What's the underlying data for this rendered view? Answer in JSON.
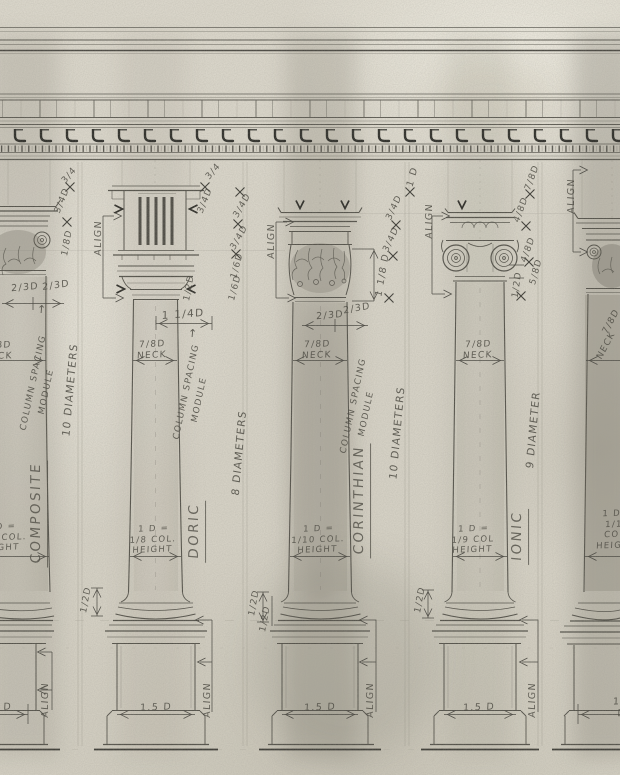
{
  "drawing": {
    "subject": "Classical orders of architecture — comparative column study in pencil",
    "orders": [
      {
        "name": "COMPOSITE",
        "height": "10 DIAMETERS",
        "neck": "7/8D NECK",
        "diameter_rule": "1 D = 1/10 COL. HEIGHT",
        "spacing": "COLUMN SPACING MODULE",
        "pedestal_width": "1.5 D"
      },
      {
        "name": "DORIC",
        "height": "8 DIAMETERS",
        "neck": "7/8D NECK",
        "diameter_rule": "1 D = 1/8 COL. HEIGHT",
        "spacing": "COLUMN SPACING MODULE",
        "pedestal_width": "1.5 D"
      },
      {
        "name": "CORINTHIAN",
        "height": "10 DIAMETERS",
        "neck": "7/8D NECK",
        "diameter_rule": "1 D = 1/10 COL. HEIGHT",
        "spacing": "COLUMN SPACING MODULE",
        "pedestal_width": "1.5 D"
      },
      {
        "name": "IONIC",
        "height": "9 DIAMETER",
        "neck": "7/8D NECK",
        "diameter_rule": "1 D = 1/9 COL HEIGHT",
        "spacing": "COLUMN SPACING MODULE",
        "pedestal_width": "1.5 D"
      }
    ]
  },
  "palette": {
    "paper": "#d7d3c7",
    "pencil": "#55534b",
    "pencil_dark": "#32312c",
    "handwriting": "#4b4941"
  },
  "annotations": [
    {
      "t": "3/4",
      "x": 70,
      "y": 176,
      "r": -50,
      "s": 9
    },
    {
      "t": "3/4D",
      "x": 63,
      "y": 201,
      "r": -68,
      "s": 9
    },
    {
      "t": "1/8D",
      "x": 68,
      "y": 243,
      "r": -80,
      "s": 9
    },
    {
      "t": "ALIGN",
      "x": 99,
      "y": 238,
      "r": -90,
      "s": 9.5,
      "n": "align-label"
    },
    {
      "t": "2/3D",
      "x": 25,
      "y": 288,
      "r": -5,
      "s": 9.5
    },
    {
      "t": "2/3D",
      "x": 56,
      "y": 286,
      "r": -8,
      "s": 9.5
    },
    {
      "t": "↑",
      "x": 42,
      "y": 310,
      "r": 0,
      "s": 11,
      "n": "arrow-up-icon"
    },
    {
      "t": "COLUMN SPACING",
      "x": 34,
      "y": 383,
      "r": -78,
      "s": 8.8,
      "n": "module-label"
    },
    {
      "t": "MODULE",
      "x": 47,
      "y": 392,
      "r": -78,
      "s": 8.8,
      "n": "module-label"
    },
    {
      "t": "10  DIAMETERS",
      "x": 71,
      "y": 390,
      "r": -85,
      "s": 10.5,
      "n": "diameters-label"
    },
    {
      "t": "COMPOSITE",
      "x": 38,
      "y": 513,
      "r": -90,
      "s": 13.5,
      "u": 1,
      "n": "order-label-composite"
    },
    {
      "t": "1 D =\n1/10 COL.\nHEIGHT",
      "x": 0,
      "y": 538,
      "r": -2,
      "s": 8.5,
      "n": "diameter-rule-label"
    },
    {
      "t": "7/8D\nNECK",
      "x": -2,
      "y": 352,
      "r": -2,
      "s": 9,
      "n": "neck-label"
    },
    {
      "t": "1.5 D",
      "x": -4,
      "y": 708,
      "r": -2,
      "s": 9.5,
      "n": "pedestal-width-label"
    },
    {
      "t": "ALIGN",
      "x": 46,
      "y": 700,
      "r": -90,
      "s": 9.5,
      "n": "align-label"
    },
    {
      "t": "3/4",
      "x": 214,
      "y": 172,
      "r": -50,
      "s": 9
    },
    {
      "t": "3/4D",
      "x": 206,
      "y": 201,
      "r": -68,
      "s": 9
    },
    {
      "t": "3/4D",
      "x": 243,
      "y": 206,
      "r": -60,
      "s": 9
    },
    {
      "t": "3/4D",
      "x": 240,
      "y": 238,
      "r": -60,
      "s": 9
    },
    {
      "t": "1/6D",
      "x": 238,
      "y": 266,
      "r": -75,
      "s": 9
    },
    {
      "t": "1/6D",
      "x": 236,
      "y": 288,
      "r": -75,
      "s": 9
    },
    {
      "t": "1/2D",
      "x": 190,
      "y": 288,
      "r": -80,
      "s": 9
    },
    {
      "t": "1 1/4D",
      "x": 183,
      "y": 315,
      "r": -4,
      "s": 10.5
    },
    {
      "t": "7/8D\nNECK",
      "x": 152,
      "y": 351,
      "r": -3,
      "s": 9,
      "n": "neck-label"
    },
    {
      "t": "↑",
      "x": 193,
      "y": 334,
      "r": 0,
      "s": 11,
      "n": "arrow-up-icon"
    },
    {
      "t": "COLUMN SPACING",
      "x": 187,
      "y": 392,
      "r": -78,
      "s": 8.8,
      "n": "module-label"
    },
    {
      "t": "MODULE",
      "x": 200,
      "y": 400,
      "r": -78,
      "s": 8.8,
      "n": "module-label"
    },
    {
      "t": "8  DIAMETERS",
      "x": 240,
      "y": 453,
      "r": -85,
      "s": 10.5,
      "n": "diameters-label"
    },
    {
      "t": "DORIC",
      "x": 196,
      "y": 531,
      "r": -90,
      "s": 13.5,
      "u": 1,
      "n": "order-label-doric"
    },
    {
      "t": "1 D =\n1/8 COL.\nHEIGHT",
      "x": 153,
      "y": 540,
      "r": -2,
      "s": 8.5,
      "n": "diameter-rule-label"
    },
    {
      "t": "1/2D",
      "x": 87,
      "y": 600,
      "r": -80,
      "s": 9
    },
    {
      "t": "1.5 D",
      "x": 156,
      "y": 708,
      "r": -2,
      "s": 9.5,
      "n": "pedestal-width-label"
    },
    {
      "t": "ALIGN",
      "x": 208,
      "y": 700,
      "r": -90,
      "s": 9.5,
      "n": "align-label"
    },
    {
      "t": "ALIGN",
      "x": 272,
      "y": 241,
      "r": -90,
      "s": 9.5,
      "n": "align-label"
    },
    {
      "t": "1 D",
      "x": 413,
      "y": 177,
      "r": -75,
      "s": 9.5
    },
    {
      "t": "3/4D",
      "x": 395,
      "y": 208,
      "r": -65,
      "s": 9
    },
    {
      "t": "3/4D",
      "x": 392,
      "y": 240,
      "r": -65,
      "s": 9
    },
    {
      "t": "1 1/8 D",
      "x": 383,
      "y": 275,
      "r": -80,
      "s": 9.5
    },
    {
      "t": "2/3D",
      "x": 330,
      "y": 316,
      "r": -5,
      "s": 9.5
    },
    {
      "t": "2/3D",
      "x": 357,
      "y": 309,
      "r": -10,
      "s": 9.5
    },
    {
      "t": "7/8D\nNECK",
      "x": 317,
      "y": 351,
      "r": -2,
      "s": 9,
      "n": "neck-label"
    },
    {
      "t": "COLUMN SPACING",
      "x": 354,
      "y": 406,
      "r": -78,
      "s": 8.8,
      "n": "module-label"
    },
    {
      "t": "MODULE",
      "x": 367,
      "y": 414,
      "r": -78,
      "s": 8.8,
      "n": "module-label"
    },
    {
      "t": "10  DIAMETERS",
      "x": 398,
      "y": 433,
      "r": -85,
      "s": 10.5,
      "n": "diameters-label"
    },
    {
      "t": "CORINTHIAN",
      "x": 361,
      "y": 500,
      "r": -90,
      "s": 13.5,
      "u": 1,
      "n": "order-label-corinthian"
    },
    {
      "t": "1 D =\n1/10 COL.\nHEIGHT",
      "x": 318,
      "y": 540,
      "r": -2,
      "s": 8.5,
      "n": "diameter-rule-label"
    },
    {
      "t": "1/2D",
      "x": 255,
      "y": 603,
      "r": -80,
      "s": 9
    },
    {
      "t": "1/2D",
      "x": 266,
      "y": 619,
      "r": -80,
      "s": 9
    },
    {
      "t": "1.5 D",
      "x": 320,
      "y": 708,
      "r": -2,
      "s": 9.5,
      "n": "pedestal-width-label"
    },
    {
      "t": "ALIGN",
      "x": 371,
      "y": 700,
      "r": -90,
      "s": 9.5,
      "n": "align-label"
    },
    {
      "t": "ALIGN",
      "x": 430,
      "y": 221,
      "r": -90,
      "s": 9.5,
      "n": "align-label"
    },
    {
      "t": "7/8D",
      "x": 533,
      "y": 178,
      "r": -70,
      "s": 9
    },
    {
      "t": "4/8D",
      "x": 522,
      "y": 210,
      "r": -70,
      "s": 9
    },
    {
      "t": "4/8D",
      "x": 529,
      "y": 250,
      "r": -70,
      "s": 9
    },
    {
      "t": "5/8D",
      "x": 537,
      "y": 272,
      "r": -75,
      "s": 9
    },
    {
      "t": "1/2D",
      "x": 518,
      "y": 285,
      "r": -82,
      "s": 9
    },
    {
      "t": "7/8D\nNECK",
      "x": 478,
      "y": 351,
      "r": -2,
      "s": 9,
      "n": "neck-label"
    },
    {
      "t": "9  DIAMETER",
      "x": 534,
      "y": 430,
      "r": -85,
      "s": 10.5,
      "n": "diameters-label"
    },
    {
      "t": "IONIC",
      "x": 519,
      "y": 536,
      "r": -90,
      "s": 13.5,
      "u": 1,
      "n": "order-label-ionic"
    },
    {
      "t": "1 D =\n1/9 COL\nHEIGHT",
      "x": 473,
      "y": 540,
      "r": -2,
      "s": 8.5,
      "n": "diameter-rule-label"
    },
    {
      "t": "1/2D",
      "x": 421,
      "y": 600,
      "r": -80,
      "s": 9
    },
    {
      "t": "1.5 D",
      "x": 479,
      "y": 708,
      "r": -2,
      "s": 9.5,
      "n": "pedestal-width-label"
    },
    {
      "t": "ALIGN",
      "x": 533,
      "y": 700,
      "r": -90,
      "s": 9.5,
      "n": "align-label"
    },
    {
      "t": "ALIGN",
      "x": 572,
      "y": 196,
      "r": -90,
      "s": 9.5,
      "n": "align-label"
    },
    {
      "t": "7/8D",
      "x": 612,
      "y": 322,
      "r": -62,
      "s": 9
    },
    {
      "t": "NECK",
      "x": 607,
      "y": 346,
      "r": -62,
      "s": 9
    },
    {
      "t": "1 D =\n1/10 COL.\nHEIGHT",
      "x": 617,
      "y": 530,
      "r": -2,
      "s": 8.5,
      "n": "diameter-rule-label"
    },
    {
      "t": "1.5 D",
      "x": 622,
      "y": 708,
      "r": -2,
      "s": 9.5,
      "n": "pedestal-width-label"
    }
  ]
}
